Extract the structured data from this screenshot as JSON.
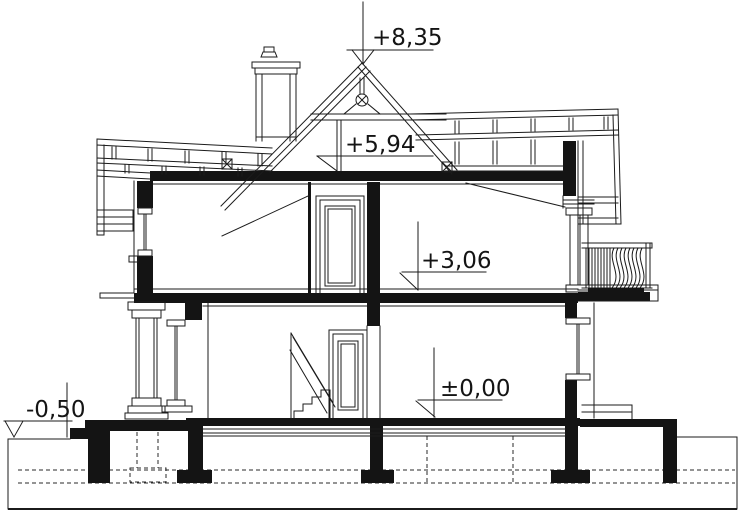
{
  "drawing": {
    "title": "House cross-section (przekrój) technical drawing",
    "type": "architectural-section",
    "colors": {
      "line": "#1b1b1b",
      "background": "#ffffff"
    },
    "levels": [
      {
        "name": "roof-ridge",
        "label": "+8,35"
      },
      {
        "name": "attic-floor",
        "label": "+5,94"
      },
      {
        "name": "first-floor",
        "label": "+3,06"
      },
      {
        "name": "ground-floor",
        "label": "±0,00"
      },
      {
        "name": "site-ground",
        "label": "-0,50"
      }
    ]
  }
}
